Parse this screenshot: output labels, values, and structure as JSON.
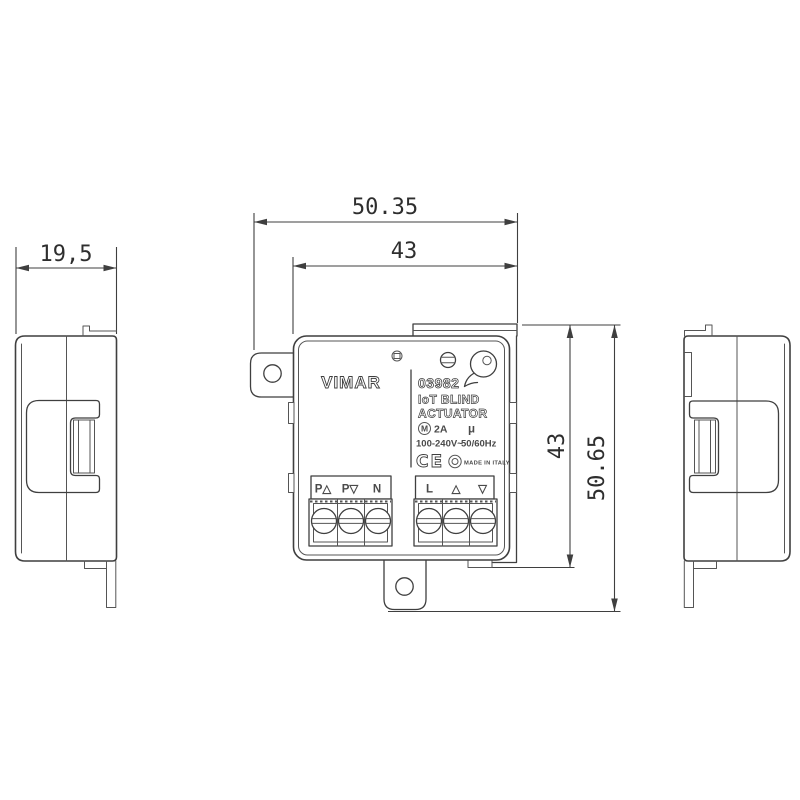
{
  "dimensions": {
    "side_depth": "19,5",
    "overall_width": "50.35",
    "cover_width": "43",
    "cover_height": "43",
    "overall_height": "50.65"
  },
  "device_label": {
    "brand": "VIMAR",
    "model": "03982",
    "product_line1": "IoT BLIND",
    "product_line2": "ACTUATOR",
    "motor_symbol": "M",
    "current_rating": "2A",
    "micro_symbol": "μ",
    "voltage": "100-240V~",
    "frequency": "50/60Hz",
    "ce_mark": "CE",
    "made_in": "MADE IN ITALY"
  },
  "terminals": {
    "left_block": [
      "P△",
      "P▽",
      "N"
    ],
    "right_block": [
      "L",
      "△",
      "▽"
    ]
  }
}
